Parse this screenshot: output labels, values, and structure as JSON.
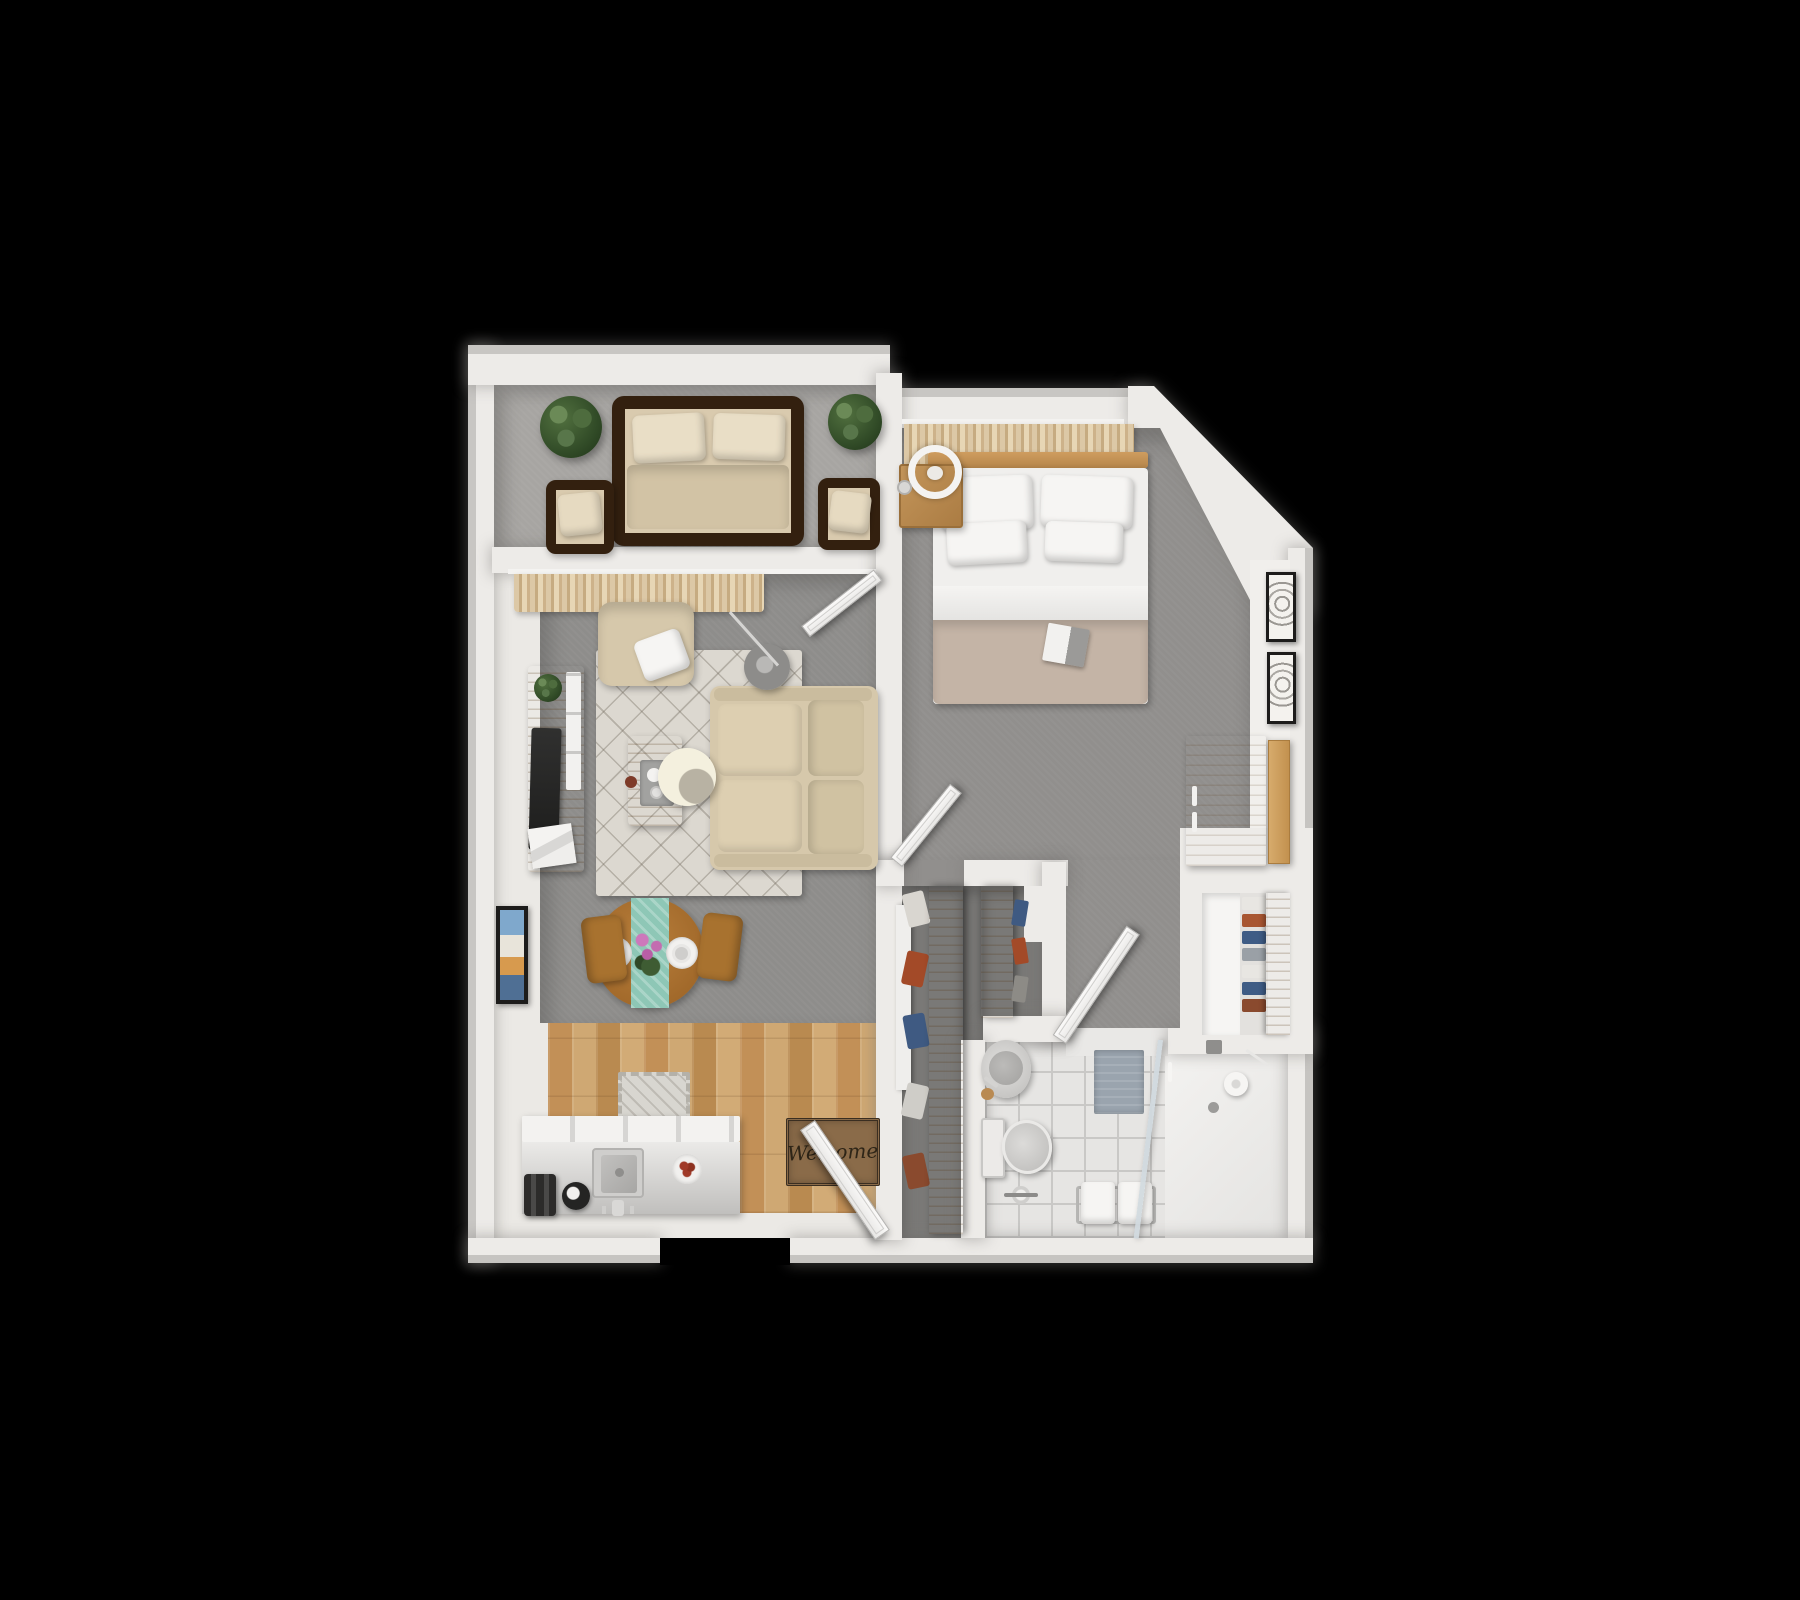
{
  "scene": {
    "description": "3D top-down rendered floor plan of a one-bedroom apartment on a black background",
    "welcome_mat_text": "Welcome"
  },
  "palette": {
    "background": "#000000",
    "wall": "#edebe8",
    "wall_face": "#f1efec",
    "balcony_floor": "#a7a5a2",
    "living_carpet": "#8e8d8b",
    "bedroom_carpet": "#918f8d",
    "closet_floor": "#7a7977",
    "kitchen_wood": "#c79e67",
    "bathroom_tile": "#e6e5e3",
    "rug_cream": "#dcd8d0",
    "sofa_beige": "#d6c8ab",
    "cushion_beige": "#d9caae",
    "wicker_dark": "#33200f",
    "pillow_white": "#f6f5f3",
    "blanket_taupe": "#c4b4a6",
    "headboard_wood": "#c49257",
    "furniture_wood": "#c0955c",
    "dining_wood": "#aa7232",
    "runner_teal": "#8ec7b6",
    "mat_brown": "#8a6b49",
    "bath_mat": "#9aa4ae",
    "plant_green": "#3e5c33",
    "tv_dark": "#262626",
    "frame_black": "#1d1c1b",
    "flower_pink": "#c36cb0",
    "accent_rust": "#a85632",
    "accent_navy": "#3f5c85"
  },
  "rooms": [
    {
      "name": "balcony",
      "floor": "gray outdoor carpet",
      "items": [
        "wicker sofa with beige cushions",
        "wicker chair left",
        "wicker chair right",
        "potted plant left",
        "potted plant right"
      ]
    },
    {
      "name": "living-room",
      "floor": "gray carpet",
      "items": [
        "window curtains",
        "balcony door",
        "armchair with white pillow",
        "beige sofa",
        "patterned area rug",
        "wood coffee table with tray",
        "arc floor lamp",
        "tv console with plant and magazines",
        "round dining table with teal runner and two place settings",
        "two dining chairs",
        "colorful wall art"
      ]
    },
    {
      "name": "kitchen",
      "floor": "light oak plank wood",
      "items": [
        "white counter with sink and faucet",
        "toaster",
        "kettle",
        "plate with food",
        "small kitchen rug",
        "welcome doormat",
        "open entry door"
      ]
    },
    {
      "name": "bedroom",
      "floor": "gray carpet",
      "items": [
        "window curtains",
        "double bed with four white pillows and taupe blanket",
        "open book on bed",
        "wood nightstand with ring lamp and clock",
        "oak wardrobe with open door",
        "two framed pictures on wall",
        "open bedroom door"
      ]
    },
    {
      "name": "closets",
      "floor": "dark gray carpet",
      "items": [
        "walk-in closet shelf with hanging clothes",
        "second closet shelf with clothes",
        "white sliding panel",
        "linen closet with folded towels on shelves"
      ]
    },
    {
      "name": "bathroom",
      "floor": "white square tile",
      "items": [
        "round vessel sink with faucet",
        "toilet with paper stand",
        "blue-gray bath mat",
        "bench with two white towels",
        "walk-in shower with glass panel and rain head",
        "open bathroom door"
      ]
    }
  ]
}
